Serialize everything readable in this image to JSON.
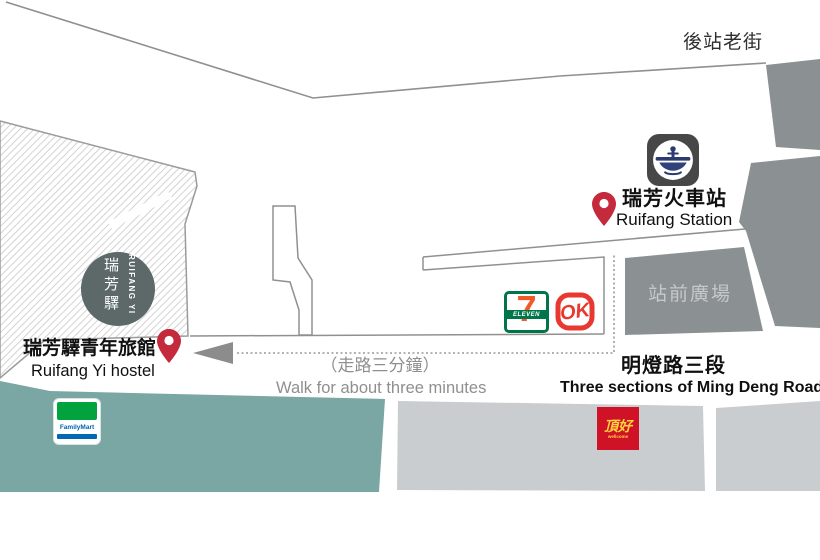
{
  "labels": {
    "back_street": "後站老街",
    "station_zh": "瑞芳火車站",
    "station_en": "Ruifang Station",
    "plaza": "站前廣場",
    "road_zh": "明燈路三段",
    "road_en": "Three sections of Ming Deng Road",
    "walk_zh": "（走路三分鐘）",
    "walk_en": "Walk for about three minutes",
    "hostel_zh": "瑞芳驛青年旅館",
    "hostel_en": "Ruifang Yi hostel"
  },
  "hostel_badge": {
    "zh": "瑞芳驛",
    "en": "RUIFANG YI"
  },
  "brands": {
    "seven_eleven": {
      "digit": "7",
      "word": "ELEVEN"
    },
    "ok_mart": {
      "word": "OK"
    },
    "family_mart": {
      "word": "FamilyMart"
    },
    "wellcome": {
      "zh": "頂好",
      "en": "wellcome"
    }
  },
  "colors": {
    "pin_red": "#c5293c",
    "teal_road": "#7aa6a3",
    "block_gray": "#8b9093",
    "light_road": "#c9cdcf",
    "outline_gray": "#909090",
    "hatch_line": "#cecece",
    "station_icon_bg": "#474747",
    "tra_navy": "#2c3a6e",
    "seven_green": "#00754a",
    "seven_orange": "#f05a28",
    "ok_red": "#e8382f",
    "family_green": "#00a33e",
    "family_blue": "#0068b7",
    "wellcome_red": "#cf1225",
    "wellcome_yellow": "#ffd23f",
    "badge_circle": "#5d6868"
  }
}
